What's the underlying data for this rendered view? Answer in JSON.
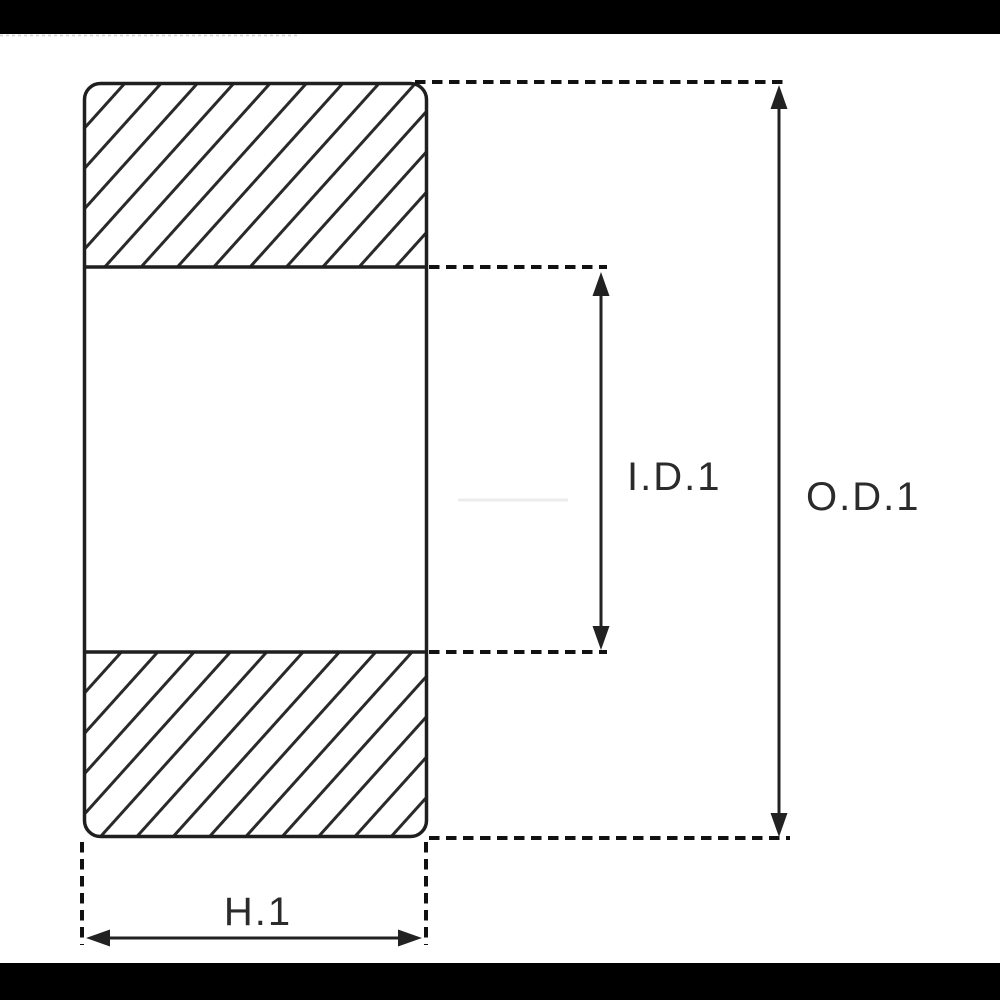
{
  "page": {
    "background": "#ffffff",
    "letterbox_color": "#000000"
  },
  "diagram": {
    "type": "bearing-cross-section-technical-drawing",
    "labels": {
      "inner_diameter": "I.D.1",
      "outer_diameter": "O.D.1",
      "width": "H.1"
    },
    "colors": {
      "outline": "#1f1f1f",
      "hatch": "#2a2a2a",
      "dashed_line": "#111111",
      "arrow": "#222222",
      "text": "#2b2b2b",
      "watermark_artifact": "#ececec"
    }
  }
}
